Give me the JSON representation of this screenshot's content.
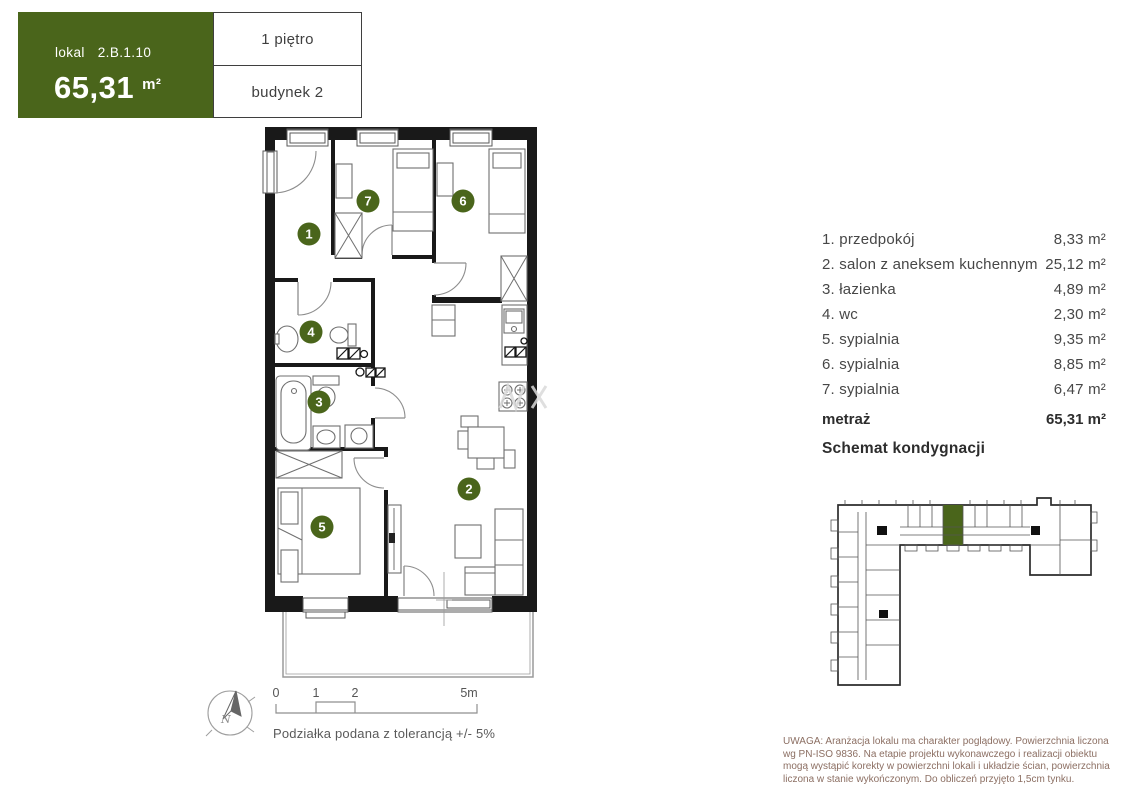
{
  "header": {
    "lokal_label": "lokal",
    "lokal_value": "2.B.1.10",
    "area_value": "65,31",
    "area_unit": "m²",
    "floor_label": "1 piętro",
    "building_label": "budynek 2"
  },
  "legend": {
    "rooms": [
      {
        "number": "1",
        "label": "1. przedpokój",
        "area": "8,33 m²"
      },
      {
        "number": "2",
        "label": "2. salon z aneksem kuchennym",
        "area": "25,12 m²"
      },
      {
        "number": "3",
        "label": "3. łazienka",
        "area": "4,89 m²"
      },
      {
        "number": "4",
        "label": "4. wc",
        "area": "2,30 m²"
      },
      {
        "number": "5",
        "label": "5. sypialnia",
        "area": "9,35 m²"
      },
      {
        "number": "6",
        "label": "6. sypialnia",
        "area": "8,85 m²"
      },
      {
        "number": "7",
        "label": "7. sypialnia",
        "area": "6,47 m²"
      }
    ],
    "total_label": "metraż",
    "total_area": "65,31 m²",
    "schematic_title": "Schemat kondygnacji"
  },
  "scalebar": {
    "ticks": [
      "0",
      "1",
      "2",
      "5m"
    ],
    "note": "Podziałka podana z tolerancją +/- 5%"
  },
  "compass": {
    "label": "N"
  },
  "disclaimer": "UWAGA: Aranżacja lokalu ma charakter poglądowy. Powierzchnia liczona wg PN-ISO 9836. Na etapie projektu wykonawczego i realizacji obiektu mogą wystąpić korekty w powierzchni lokali i układzie ścian, powierzchnia liczona w stanie wykończonym. Do obliczeń przyjęto 1,5cm tynku.",
  "colors": {
    "brand_green": "#4a651b",
    "wall_black": "#191919",
    "disclaimer_text": "#8c6f63"
  }
}
